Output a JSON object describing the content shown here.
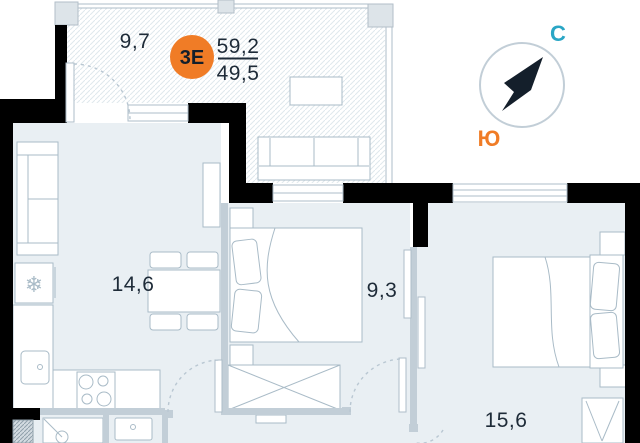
{
  "plan": {
    "unit_badge": {
      "type_label": "3Е",
      "total_area": "59,2",
      "living_area": "49,5"
    },
    "rooms": [
      {
        "name": "balcony",
        "area": "9,7"
      },
      {
        "name": "kitchen-living",
        "area": "14,6"
      },
      {
        "name": "bedroom-small",
        "area": "9,3"
      },
      {
        "name": "bedroom-large",
        "area": "15,6"
      }
    ],
    "compass": {
      "north_label": "С",
      "south_label": "Ю"
    },
    "icons": {
      "freezer": "❄"
    }
  },
  "colors": {
    "wall": "#000000",
    "ink": "#1e2b38",
    "accent_orange": "#f07c26",
    "accent_teal": "#2aa6c5",
    "needle": "#141f2b",
    "room_fill": "#e9eff3",
    "gray_wall": "#c2ced7",
    "furn_line": "#a9bbc7",
    "frame_line": "#aebdc8",
    "hatch_line": "#dfe8ed",
    "arc_line": "#b9c7d2",
    "outside": "#ffffff"
  }
}
